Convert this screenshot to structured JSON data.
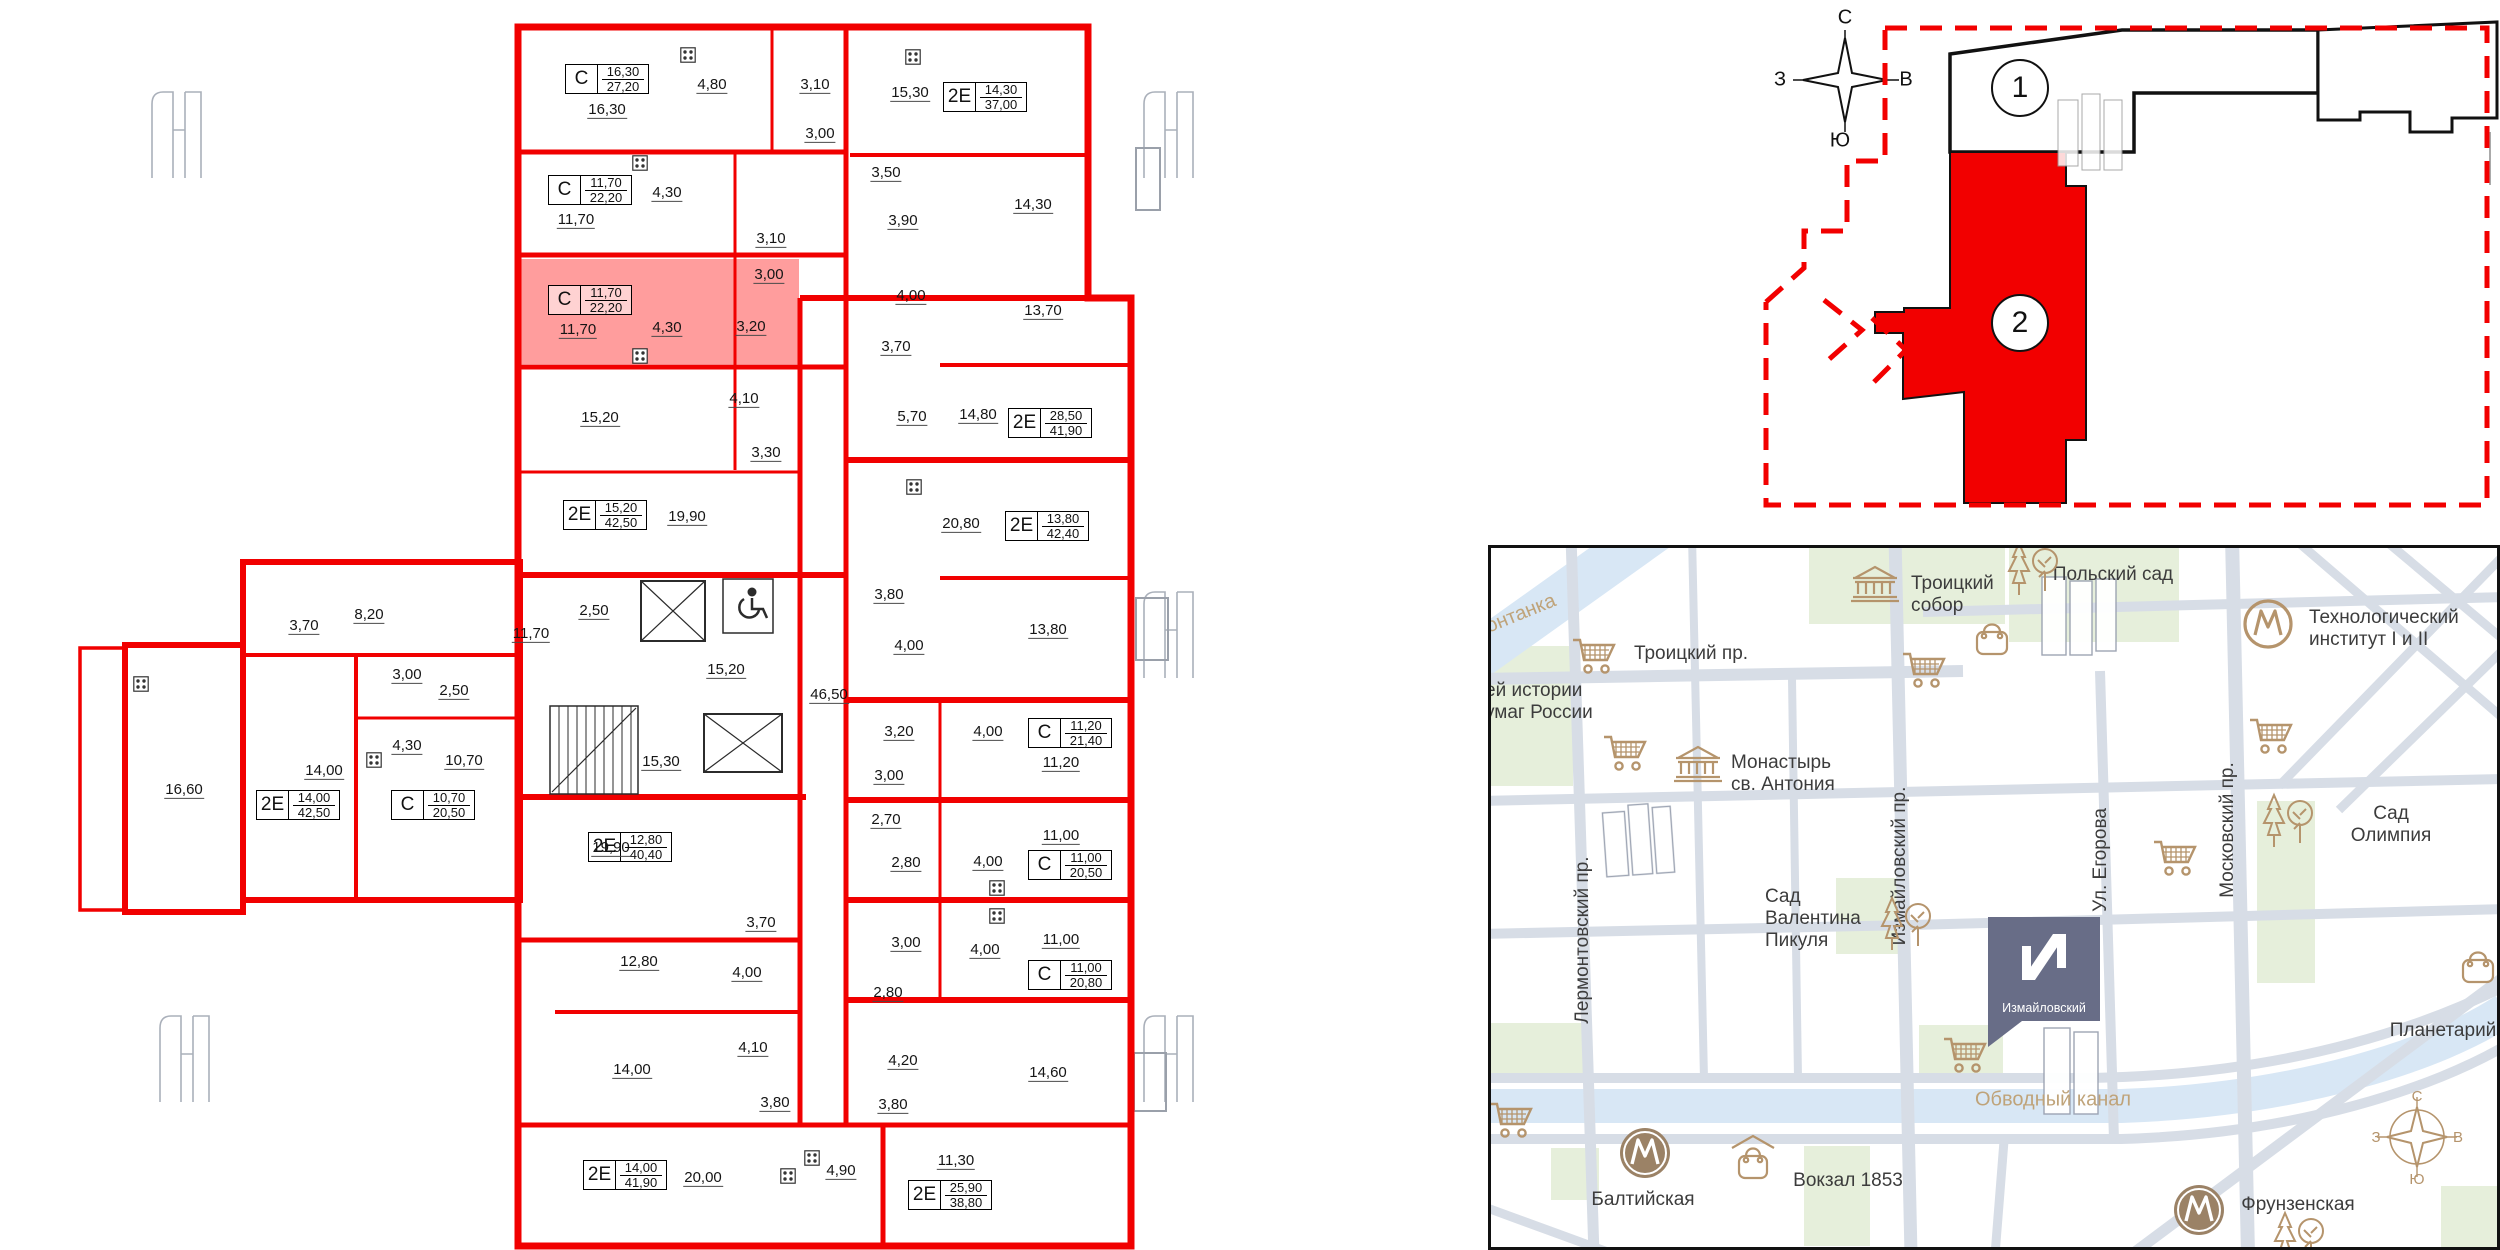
{
  "colors": {
    "wall_red": "#f10000",
    "selected_fill": "#ff9d9d",
    "map_tan": "#b5946c",
    "metro_brown": "#9b8266",
    "pin_bg": "#686d87",
    "water": "#d8e7f5",
    "park": "#e6efdb",
    "street": "#d7dde6"
  },
  "floorplan": {
    "apartments": [
      {
        "t": "С",
        "a": "16,30",
        "b": "27,20",
        "x": 565,
        "y": 64
      },
      {
        "t": "С",
        "a": "11,70",
        "b": "22,20",
        "x": 548,
        "y": 175
      },
      {
        "t": "С",
        "a": "11,70",
        "b": "22,20",
        "x": 548,
        "y": 285,
        "sel": true
      },
      {
        "t": "2Е",
        "a": "15,20",
        "b": "42,50",
        "x": 563,
        "y": 500
      },
      {
        "t": "2Е",
        "a": "12,80",
        "b": "40,40",
        "x": 588,
        "y": 832
      },
      {
        "t": "2Е",
        "a": "14,00",
        "b": "41,90",
        "x": 583,
        "y": 1160
      },
      {
        "t": "2Е",
        "a": "14,30",
        "b": "37,00",
        "x": 943,
        "y": 82
      },
      {
        "t": "2Е",
        "a": "28,50",
        "b": "41,90",
        "x": 1008,
        "y": 408
      },
      {
        "t": "2Е",
        "a": "13,80",
        "b": "42,40",
        "x": 1005,
        "y": 511
      },
      {
        "t": "С",
        "a": "11,20",
        "b": "21,40",
        "x": 1028,
        "y": 718
      },
      {
        "t": "С",
        "a": "11,00",
        "b": "20,50",
        "x": 1028,
        "y": 850
      },
      {
        "t": "С",
        "a": "11,00",
        "b": "20,80",
        "x": 1028,
        "y": 960
      },
      {
        "t": "2Е",
        "a": "25,90",
        "b": "38,80",
        "x": 908,
        "y": 1180
      },
      {
        "t": "2Е",
        "a": "14,00",
        "b": "42,50",
        "x": 256,
        "y": 790
      },
      {
        "t": "С",
        "a": "10,70",
        "b": "20,50",
        "x": 391,
        "y": 790
      }
    ],
    "dims": [
      [
        "16,30",
        607,
        110
      ],
      [
        "4,80",
        712,
        85
      ],
      [
        "3,10",
        815,
        85
      ],
      [
        "15,30",
        910,
        93
      ],
      [
        "3,00",
        820,
        134
      ],
      [
        "11,70",
        576,
        220
      ],
      [
        "4,30",
        667,
        193
      ],
      [
        "3,10",
        771,
        239
      ],
      [
        "3,50",
        886,
        173
      ],
      [
        "3,90",
        903,
        221
      ],
      [
        "14,30",
        1033,
        205
      ],
      [
        "11,70",
        578,
        330,
        1
      ],
      [
        "4,30",
        667,
        328,
        1
      ],
      [
        "3,00",
        769,
        275,
        1
      ],
      [
        "3,20",
        751,
        327,
        1
      ],
      [
        "15,20",
        600,
        418
      ],
      [
        "4,10",
        744,
        399
      ],
      [
        "3,30",
        766,
        453
      ],
      [
        "4,00",
        911,
        296
      ],
      [
        "13,70",
        1043,
        311
      ],
      [
        "3,70",
        896,
        347
      ],
      [
        "5,70",
        912,
        417
      ],
      [
        "14,80",
        978,
        415
      ],
      [
        "19,90",
        687,
        517
      ],
      [
        "2,50",
        594,
        611
      ],
      [
        "11,70",
        531,
        634
      ],
      [
        "15,20",
        726,
        670
      ],
      [
        "46,50",
        829,
        695
      ],
      [
        "15,30",
        661,
        762
      ],
      [
        "20,80",
        961,
        524
      ],
      [
        "3,80",
        889,
        595
      ],
      [
        "4,00",
        909,
        646
      ],
      [
        "13,80",
        1048,
        630
      ],
      [
        "3,20",
        899,
        732
      ],
      [
        "4,00",
        988,
        732
      ],
      [
        "11,20",
        1061,
        763
      ],
      [
        "3,00",
        889,
        776
      ],
      [
        "19,90",
        611,
        848
      ],
      [
        "3,70",
        761,
        923
      ],
      [
        "2,70",
        886,
        820
      ],
      [
        "2,80",
        906,
        863
      ],
      [
        "4,00",
        988,
        862
      ],
      [
        "11,00",
        1061,
        836
      ],
      [
        "3,00",
        906,
        943
      ],
      [
        "4,00",
        985,
        950
      ],
      [
        "11,00",
        1061,
        940
      ],
      [
        "2,80",
        888,
        993
      ],
      [
        "12,80",
        639,
        962
      ],
      [
        "4,00",
        747,
        973
      ],
      [
        "14,00",
        632,
        1070
      ],
      [
        "4,10",
        753,
        1048
      ],
      [
        "3,80",
        775,
        1103
      ],
      [
        "20,00",
        703,
        1178
      ],
      [
        "4,90",
        841,
        1171
      ],
      [
        "4,20",
        903,
        1061
      ],
      [
        "14,60",
        1048,
        1073
      ],
      [
        "3,80",
        893,
        1105
      ],
      [
        "11,30",
        956,
        1161
      ],
      [
        "3,70",
        304,
        626
      ],
      [
        "8,20",
        369,
        615
      ],
      [
        "3,00",
        407,
        675
      ],
      [
        "2,50",
        454,
        691
      ],
      [
        "4,30",
        407,
        746
      ],
      [
        "10,70",
        464,
        761
      ],
      [
        "14,00",
        324,
        771
      ],
      [
        "16,60",
        184,
        790
      ]
    ],
    "stoves": [
      [
        688,
        55
      ],
      [
        640,
        163
      ],
      [
        640,
        356
      ],
      [
        913,
        57
      ],
      [
        914,
        487
      ],
      [
        997,
        888
      ],
      [
        997,
        916
      ],
      [
        374,
        760
      ],
      [
        141,
        684
      ],
      [
        788,
        1176
      ],
      [
        812,
        1158
      ]
    ]
  },
  "site": {
    "compass": {
      "n": "С",
      "s": "Ю",
      "w": "З",
      "e": "В"
    },
    "sections": [
      {
        "n": "1",
        "x": 2020,
        "y": 88
      },
      {
        "n": "2",
        "x": 2020,
        "y": 323
      }
    ]
  },
  "map": {
    "pin_label": "Измайловский",
    "compass": {
      "n": "С",
      "s": "Ю",
      "w": "З",
      "e": "В"
    },
    "labels": [
      {
        "t": "онтанка",
        "x": 30,
        "y": 66,
        "c": "water",
        "r": -22
      },
      {
        "t": "Троицкий пр.",
        "x": 200,
        "y": 106
      },
      {
        "t": "ей истории\nумаг  России",
        "x": -6,
        "y": 154,
        "al": 1
      },
      {
        "t": "Троицкий\nсобор",
        "x": 420,
        "y": 47,
        "al": 1
      },
      {
        "t": "Польский сад",
        "x": 622,
        "y": 27
      },
      {
        "t": "Технологический\nинститут I и II",
        "x": 818,
        "y": 81,
        "al": 1
      },
      {
        "t": "Монастырь\nсв. Антония",
        "x": 240,
        "y": 226,
        "al": 1
      },
      {
        "t": "Сад\nВалентина\nПикуля",
        "x": 274,
        "y": 371,
        "al": 1
      },
      {
        "t": "Сад Олимпия",
        "x": 900,
        "y": 277
      },
      {
        "t": "Планетарий",
        "x": 952,
        "y": 483
      },
      {
        "t": "Балтийская",
        "x": 152,
        "y": 652
      },
      {
        "t": "Вокзал 1853",
        "x": 357,
        "y": 633
      },
      {
        "t": "Фрунзенская",
        "x": 807,
        "y": 657
      },
      {
        "t": "Обводный канал",
        "x": 562,
        "y": 552,
        "c": "water"
      },
      {
        "t": "Лермонтовский пр.",
        "x": 92,
        "y": 392,
        "r": -90
      },
      {
        "t": "Измайловский пр.",
        "x": 409,
        "y": 318,
        "r": -90
      },
      {
        "t": "Ул. Егорова",
        "x": 610,
        "y": 312,
        "r": -90
      },
      {
        "t": "Московский пр.",
        "x": 737,
        "y": 282,
        "r": -90
      }
    ],
    "icons": [
      [
        "cart",
        103,
        108
      ],
      [
        "cart",
        433,
        122
      ],
      [
        "cart",
        134,
        205
      ],
      [
        "cart",
        780,
        188
      ],
      [
        "cart",
        684,
        310
      ],
      [
        "cart",
        474,
        507
      ],
      [
        "cart",
        20,
        572
      ],
      [
        "trees",
        542,
        20
      ],
      [
        "trees",
        797,
        272
      ],
      [
        "trees",
        415,
        375
      ],
      [
        "trees",
        808,
        690
      ],
      [
        "classical",
        384,
        36
      ],
      [
        "classical",
        207,
        216
      ],
      [
        "bag",
        501,
        90
      ],
      [
        "bag",
        987,
        418
      ],
      [
        "bagroof",
        262,
        610
      ],
      [
        "metro-o",
        777,
        76
      ],
      [
        "metro-f",
        154,
        605
      ],
      [
        "metro-f",
        708,
        662
      ],
      [
        "compass-sm",
        926,
        589
      ]
    ]
  }
}
